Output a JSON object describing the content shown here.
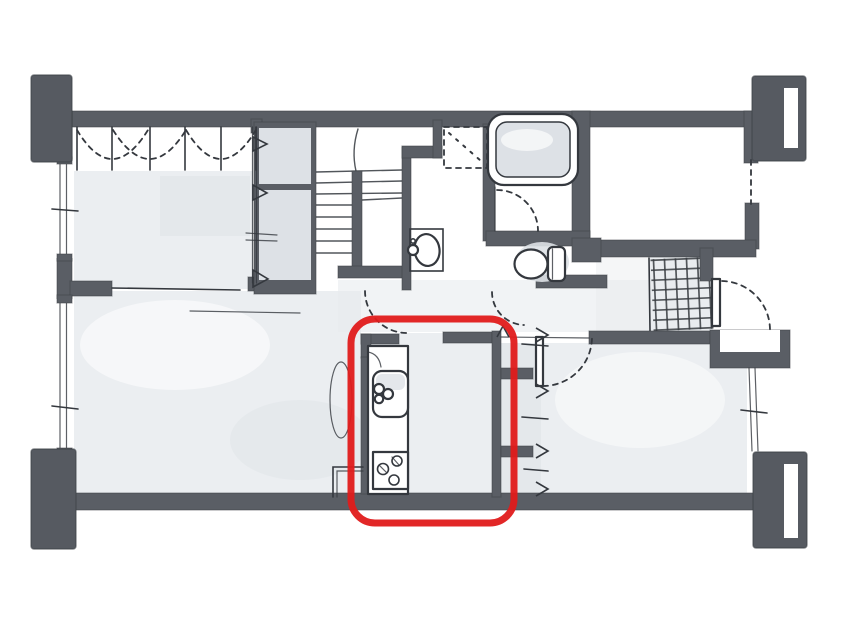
{
  "meta": {
    "description": "Hand-drawn watercolor-style apartment floor plan sketch. A thick red rounded rectangle highlights the kitchen strip (sink and stove counter) in the lower center of the plan. No text labels are printed on the drawing.",
    "drawing_type": "floor-plan-sketch"
  },
  "colors": {
    "background": "#ffffff",
    "wall": "#5a5e65",
    "pillar": "#565a61",
    "wall-edge": "#3e4248",
    "ink": "#34383e",
    "wash": "#e8ebee",
    "wash-deep": "#dde1e6",
    "tile-line": "#383c41",
    "highlight-red": "#e01b1b"
  },
  "highlight": {
    "name": "kitchen-highlight",
    "shape": "rounded-rectangle",
    "color": "#e01b1b",
    "highlighted_area": "kitchen counter with sink and stove"
  },
  "rooms": [
    "western-room-with-closet",
    "staircase-hall",
    "washroom",
    "bathroom",
    "toilet",
    "entrance-hall",
    "living-dining",
    "kitchen",
    "bedroom",
    "upper-void"
  ],
  "fixtures": [
    "closet-folding-doors",
    "wall-closet-boxes",
    "switchback-stairs",
    "washing-machine-pan",
    "washbasin",
    "bathtub",
    "toilet-bowl",
    "entrance-tile-grid",
    "shoe-cabinet",
    "kitchen-sink",
    "gas-stove",
    "windows",
    "door-swing-arcs",
    "corner-pillars"
  ]
}
